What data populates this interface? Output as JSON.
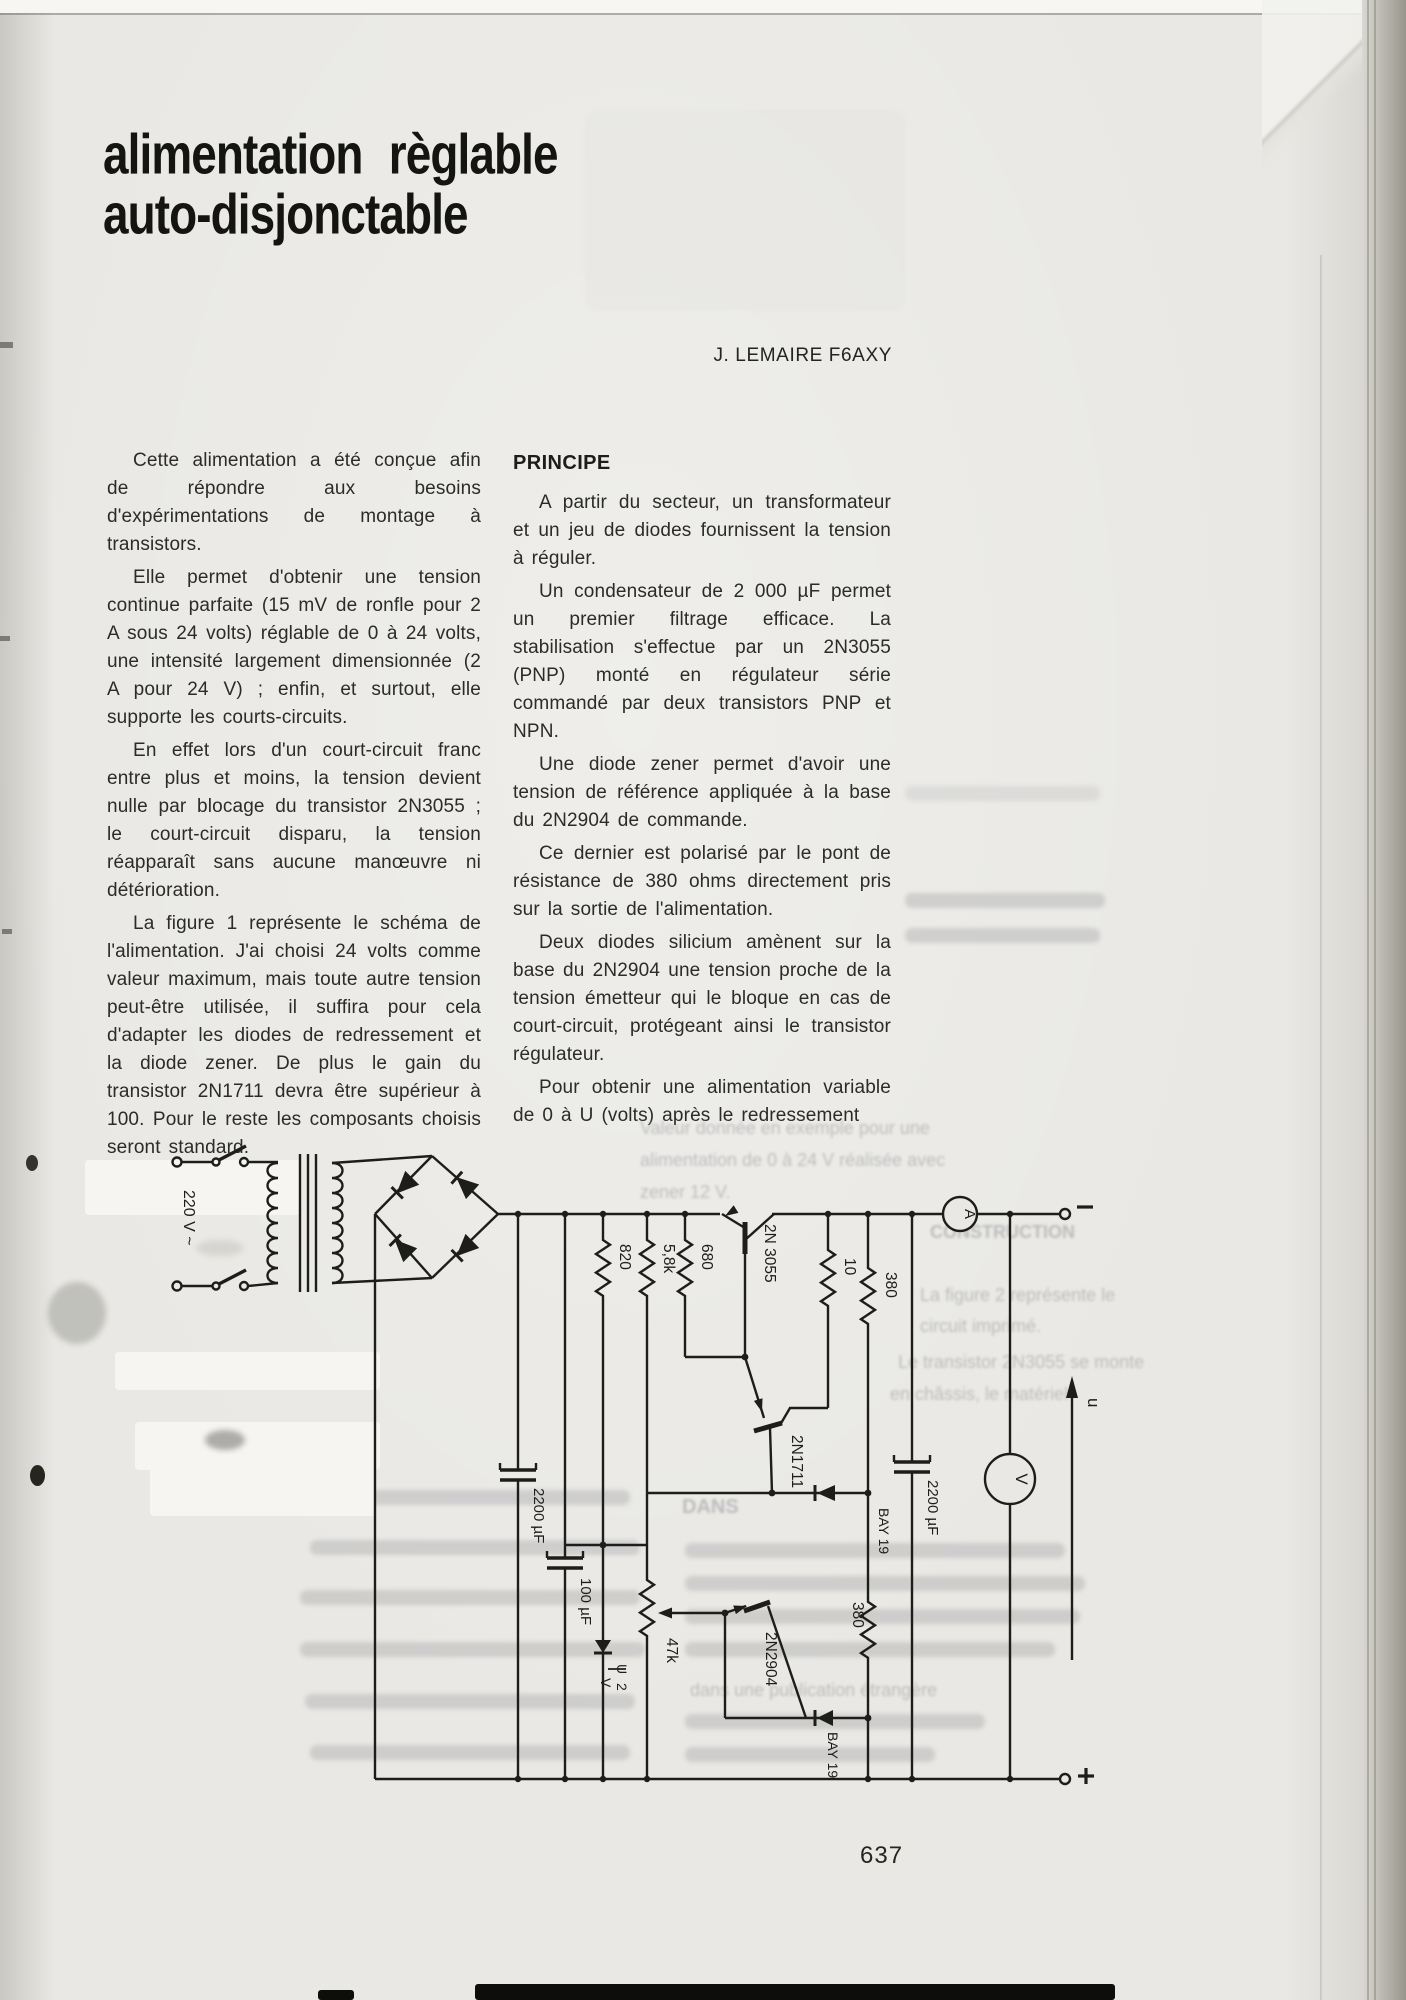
{
  "page": {
    "title_line1": "alimentation règlable",
    "title_line2": "auto-disjonctable",
    "author": "J. LEMAIRE F6AXY",
    "page_number": "637"
  },
  "left_column": {
    "paragraphs": [
      "Cette alimentation a été conçue afin de répondre aux besoins d'expérimentations de montage à transistors.",
      "Elle permet d'obtenir une tension continue parfaite (15 mV de ronfle pour 2 A sous 24 volts) réglable de 0 à 24 volts, une intensité largement dimensionnée (2 A pour 24 V) ; enfin, et surtout, elle supporte les courts-circuits.",
      "En effet lors d'un court-circuit franc entre plus et moins, la tension devient nulle par blocage du transistor 2N3055 ; le court-circuit disparu, la tension réapparaît sans aucune manœuvre ni détérioration.",
      "La figure 1 représente le schéma de l'alimentation. J'ai choisi 24 volts comme valeur maximum, mais toute autre tension peut-être utilisée, il suffira pour cela d'adapter les diodes de redressement et la diode zener. De plus le gain du transistor 2N1711 devra être supérieur à 100. Pour le reste les composants choisis seront standard."
    ]
  },
  "right_column": {
    "heading": "PRINCIPE",
    "paragraphs": [
      "A partir du secteur, un transformateur et un jeu de diodes fournissent la tension à réguler.",
      "Un condensateur de 2 000 µF permet un premier filtrage efficace. La stabilisation s'effectue par un 2N3055 (PNP) monté en régulateur série commandé par deux transistors PNP et NPN.",
      "Une diode zener permet d'avoir une tension de référence appliquée à la base du 2N2904 de commande.",
      "Ce dernier est polarisé par le pont de résistance de 380 ohms directement pris sur la sortie de l'alimentation.",
      "Deux diodes silicium amènent sur la base du 2N2904 une tension proche de la tension émetteur qui le bloque en cas de court-circuit, protégeant ainsi le transistor régulateur.",
      "Pour obtenir une alimentation variable de 0 à U (volts) après le redressement"
    ]
  },
  "schematic": {
    "v220": "220 V ~",
    "q1": "2N 3055",
    "q2": "2N1711",
    "q3": "2N2904",
    "r820": "820",
    "r58k": "5,8k",
    "r680": "680",
    "r10": "10",
    "r380a": "380",
    "r380b": "380",
    "r47k": "47k",
    "d1": "BAY 19",
    "d2": "BAY 19",
    "c1": "2200 µF",
    "c2": "100 µF",
    "c3": "2200 µF",
    "zu": "U",
    "z2": "2",
    "zv": "V",
    "ammeter": "A",
    "voltmeter": "V",
    "u_arrow": "u",
    "minus": "−",
    "plus": "+"
  },
  "ghost": {
    "g1": "Valeur donnée en exemple pour une",
    "g2": "alimentation de 0 à 24 V réalisée avec",
    "g3": "zener 12 V.",
    "g4": "CONSTRUCTION",
    "g5": "La figure 2 représente le",
    "g6": "circuit imprimé.",
    "g7": "Le transistor 2N3055 se monte",
    "g8": "en châssis, le matériel",
    "g9": "DANS",
    "g10": "dans une publication étrangère"
  }
}
